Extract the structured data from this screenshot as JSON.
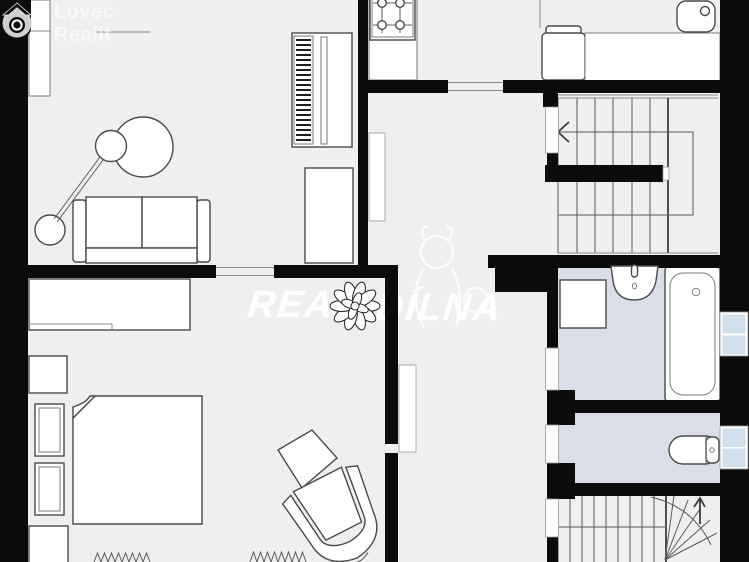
{
  "branding": {
    "logo_line1": "Lovec",
    "logo_line2": "Realit",
    "logo_icon": "house-lens-icon"
  },
  "watermark": {
    "fragment_left": "REAL",
    "fragment_right": "DÍLNA",
    "mascot": "dog-with-magnifier-outline"
  },
  "colors": {
    "floor": "#efeff1",
    "walls": "#0b0b0b",
    "bathroom_floor": "#d9dee8",
    "window_pane": "#cfe0ec",
    "fixture_outline": "#4a4a4a",
    "watermark_white": "#fcfcfc"
  },
  "floorplan": {
    "type": "apartment-floor-plan",
    "rooms": [
      {
        "name": "living-room",
        "fixtures": [
          "sofa",
          "floor-lamp",
          "piano",
          "cabinet",
          "wall-closet"
        ]
      },
      {
        "name": "kitchen",
        "fixtures": [
          "stove-4-burners",
          "counter"
        ]
      },
      {
        "name": "utility-area",
        "fixtures": [
          "boiler",
          "counter",
          "sink"
        ]
      },
      {
        "name": "hallway",
        "fixtures": [
          "open-door",
          "open-door"
        ]
      },
      {
        "name": "bedroom",
        "fixtures": [
          "double-bed",
          "wardrobe",
          "nightstand",
          "nightstand",
          "dresser",
          "armchair",
          "ottoman",
          "radiator",
          "radiator",
          "potted-plant"
        ]
      },
      {
        "name": "bathroom",
        "fixtures": [
          "washbasin",
          "shower-cabin",
          "bathtub",
          "window"
        ]
      },
      {
        "name": "wc",
        "fixtures": [
          "toilet",
          "window"
        ]
      },
      {
        "name": "staircase",
        "fixtures": [
          "u-shaped-stairs-with-arrow",
          "winder-stairs-with-arrow"
        ]
      }
    ]
  }
}
